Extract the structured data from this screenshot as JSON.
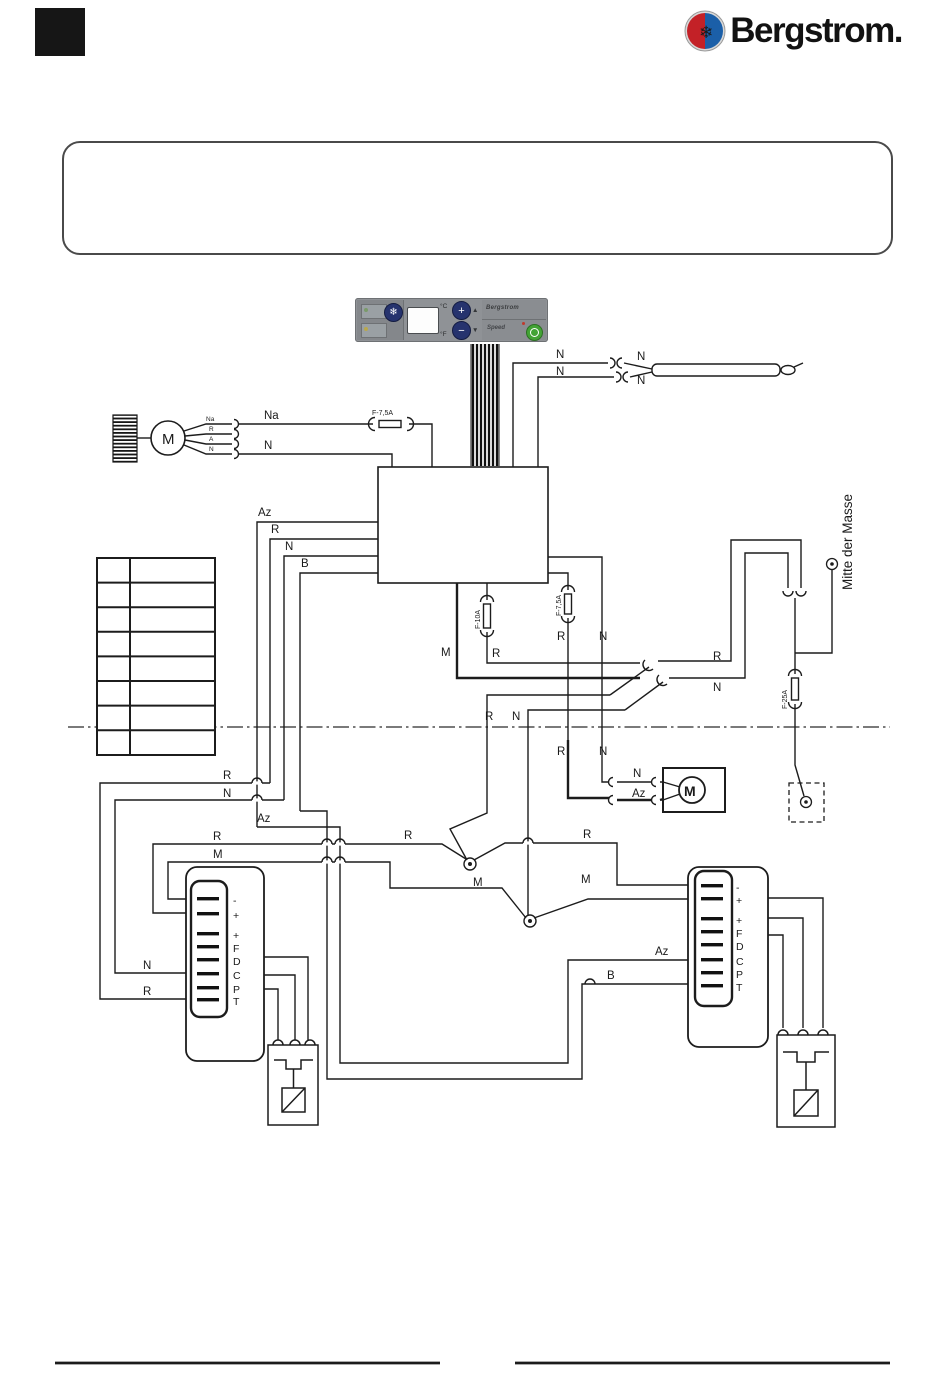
{
  "header": {
    "brand_name": "Bergstrom.",
    "logo_icon": "bergstrom-snowflake-emblem"
  },
  "panel": {
    "snowflake": "❄",
    "celsius": "°C",
    "fahrenheit": "°F",
    "temp_up": "+",
    "temp_down": "−",
    "up_arrow": "▲",
    "down_arrow": "▼",
    "brand_text": "Bergstrom",
    "speed_text": "Speed"
  },
  "diagram": {
    "ground_text": "Mitte der Masse",
    "pin_labels": [
      "-",
      "+",
      "+",
      "F",
      "D",
      "C",
      "P",
      "T"
    ],
    "table_rows": 8,
    "labels": [
      {
        "t": "N",
        "x": 556,
        "y": 358
      },
      {
        "t": "N",
        "x": 637,
        "y": 360
      },
      {
        "t": "N",
        "x": 556,
        "y": 375
      },
      {
        "t": "N",
        "x": 637,
        "y": 384
      },
      {
        "t": "Na",
        "x": 206,
        "y": 421,
        "s": 6.5
      },
      {
        "t": "R",
        "x": 209,
        "y": 431,
        "s": 6.5
      },
      {
        "t": "A",
        "x": 209,
        "y": 441,
        "s": 6.5
      },
      {
        "t": "N",
        "x": 209,
        "y": 451,
        "s": 6.5
      },
      {
        "t": "Na",
        "x": 264,
        "y": 419
      },
      {
        "t": "N",
        "x": 264,
        "y": 449
      },
      {
        "t": "F-7,5A",
        "x": 372,
        "y": 415,
        "s": 7
      },
      {
        "t": "Az",
        "x": 258,
        "y": 516
      },
      {
        "t": "R",
        "x": 271,
        "y": 533
      },
      {
        "t": "N",
        "x": 285,
        "y": 550
      },
      {
        "t": "B",
        "x": 301,
        "y": 567
      },
      {
        "t": "F-10A",
        "x": 480,
        "y": 629,
        "s": 7,
        "r": -90
      },
      {
        "t": "R",
        "x": 492,
        "y": 657
      },
      {
        "t": "M",
        "x": 441,
        "y": 656
      },
      {
        "t": "F-7,5A",
        "x": 561,
        "y": 616,
        "s": 7,
        "r": -90
      },
      {
        "t": "R",
        "x": 557,
        "y": 640
      },
      {
        "t": "N",
        "x": 599,
        "y": 640
      },
      {
        "t": "R",
        "x": 713,
        "y": 660
      },
      {
        "t": "N",
        "x": 713,
        "y": 691
      },
      {
        "t": "R",
        "x": 485,
        "y": 720
      },
      {
        "t": "N",
        "x": 512,
        "y": 720
      },
      {
        "t": "R",
        "x": 557,
        "y": 755
      },
      {
        "t": "N",
        "x": 599,
        "y": 755
      },
      {
        "t": "F-25A",
        "x": 787,
        "y": 709,
        "s": 7,
        "r": -90
      },
      {
        "t": "Mitte der Masse",
        "x": 852,
        "y": 590,
        "s": 13.5,
        "r": -90
      },
      {
        "t": "R",
        "x": 223,
        "y": 779
      },
      {
        "t": "N",
        "x": 223,
        "y": 797
      },
      {
        "t": "Az",
        "x": 257,
        "y": 822
      },
      {
        "t": "N",
        "x": 633,
        "y": 777
      },
      {
        "t": "Az",
        "x": 632,
        "y": 797
      },
      {
        "t": "R",
        "x": 213,
        "y": 840
      },
      {
        "t": "M",
        "x": 213,
        "y": 858
      },
      {
        "t": "R",
        "x": 404,
        "y": 839
      },
      {
        "t": "R",
        "x": 583,
        "y": 838
      },
      {
        "t": "M",
        "x": 473,
        "y": 886
      },
      {
        "t": "M",
        "x": 581,
        "y": 883
      },
      {
        "t": "Az",
        "x": 655,
        "y": 955
      },
      {
        "t": "B",
        "x": 607,
        "y": 979
      },
      {
        "t": "N",
        "x": 143,
        "y": 969
      },
      {
        "t": "R",
        "x": 143,
        "y": 995
      },
      {
        "t": "M",
        "x": 162,
        "y": 444,
        "s": 15
      },
      {
        "t": "M",
        "x": 684,
        "y": 796,
        "s": 14,
        "b": 1
      }
    ]
  }
}
